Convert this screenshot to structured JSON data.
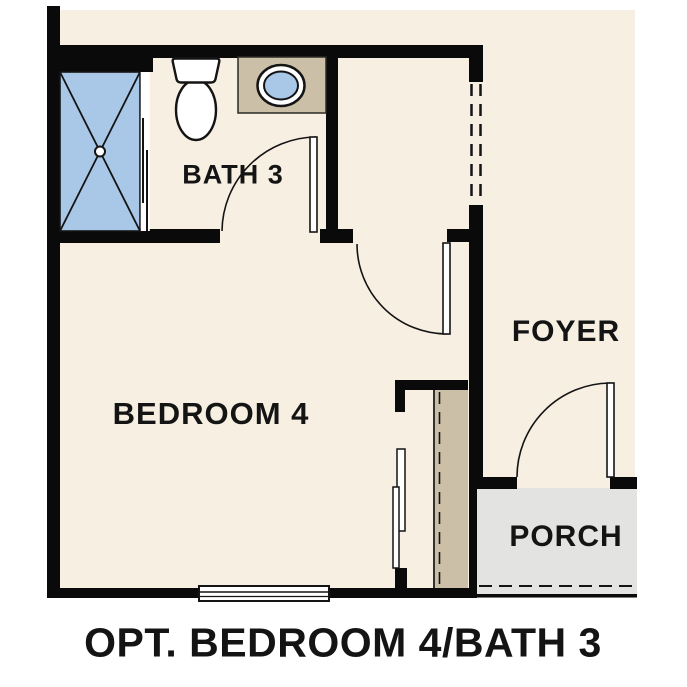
{
  "title": "OPT. BEDROOM 4/BATH 3",
  "rooms": {
    "bath": {
      "label": "BATH 3"
    },
    "bedroom": {
      "label": "BEDROOM 4"
    },
    "foyer": {
      "label": "FOYER"
    },
    "porch": {
      "label": "PORCH"
    }
  },
  "fixtures": {
    "shower": "shower-stall",
    "toilet": "toilet",
    "sink": "vanity-sink",
    "window": "window",
    "closet_doors": "bypass-closet-doors",
    "bath_door": "hinged-door",
    "bedroom_door": "hinged-door",
    "entry_door": "hinged-door"
  },
  "colors": {
    "floor": "#f7efe2",
    "wall": "#0a0a0a",
    "shower-blue": "#a9c8e8",
    "counter-tan": "#cbbfa7",
    "porch-gray": "#e3e3e1",
    "line": "#141414",
    "text": "#141414",
    "page-bg": "#ffffff"
  }
}
